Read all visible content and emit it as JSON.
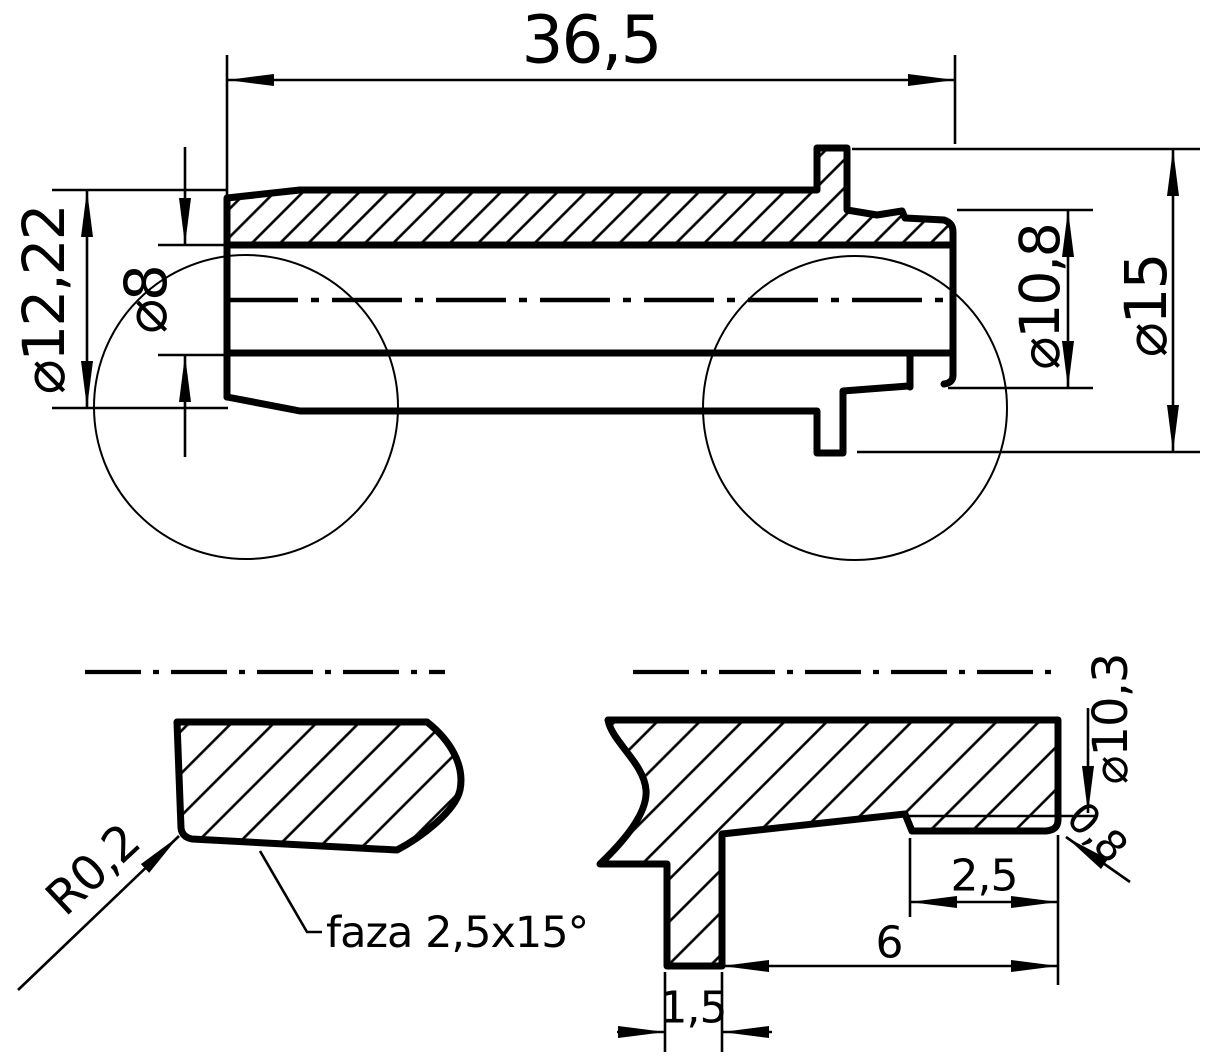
{
  "drawing": {
    "kind": "technical-section-drawing",
    "line_color": "#000000",
    "background_color": "#ffffff",
    "main_view": {
      "dimensions": {
        "total_length": "36,5",
        "outer_diameter_left": "⌀12,22",
        "bore_diameter": "⌀8",
        "recess_diameter": "⌀10,8",
        "flange_diameter": "⌀15"
      }
    },
    "detail_left": {
      "labels": {
        "edge_radius": "R0,2",
        "chamfer_note": "faza 2,5x15°"
      }
    },
    "detail_right": {
      "dimensions": {
        "groove_diameter": "⌀10,3",
        "corner_radius": "0,8",
        "groove_width": "2,5",
        "recess_length": "6",
        "flange_thickness": "1,5"
      }
    }
  }
}
